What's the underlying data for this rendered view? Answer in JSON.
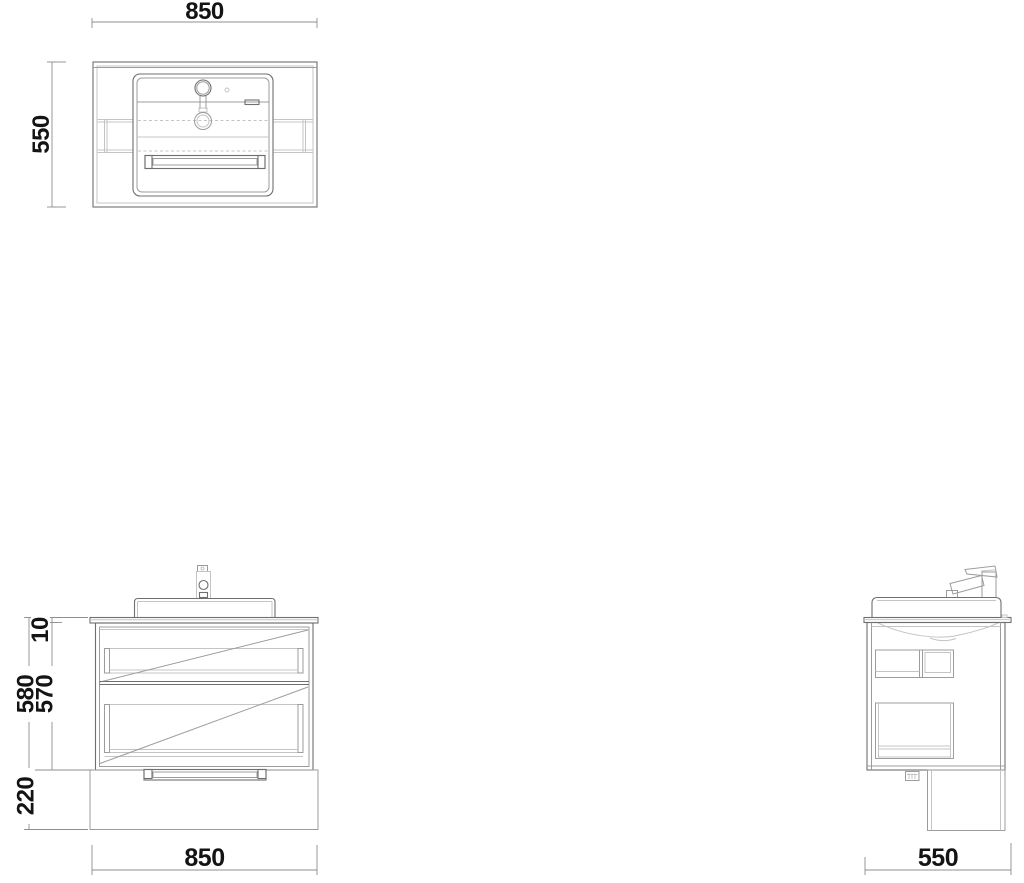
{
  "drawing": {
    "views": {
      "top": {
        "dim_width": "850",
        "dim_depth": "550"
      },
      "front": {
        "dim_width": "850",
        "dim_countertop": "10",
        "dim_total_height": "580",
        "dim_cabinet_height": "570",
        "dim_plinth_height": "220"
      },
      "side": {
        "dim_depth": "550"
      }
    },
    "colors": {
      "background": "#ffffff",
      "line_primary": "#6f6f6f",
      "line_secondary": "#9c9c9c",
      "line_hidden": "#c4c4c4",
      "dimension_line": "#8f8f8f",
      "dimension_text": "#141414"
    }
  }
}
